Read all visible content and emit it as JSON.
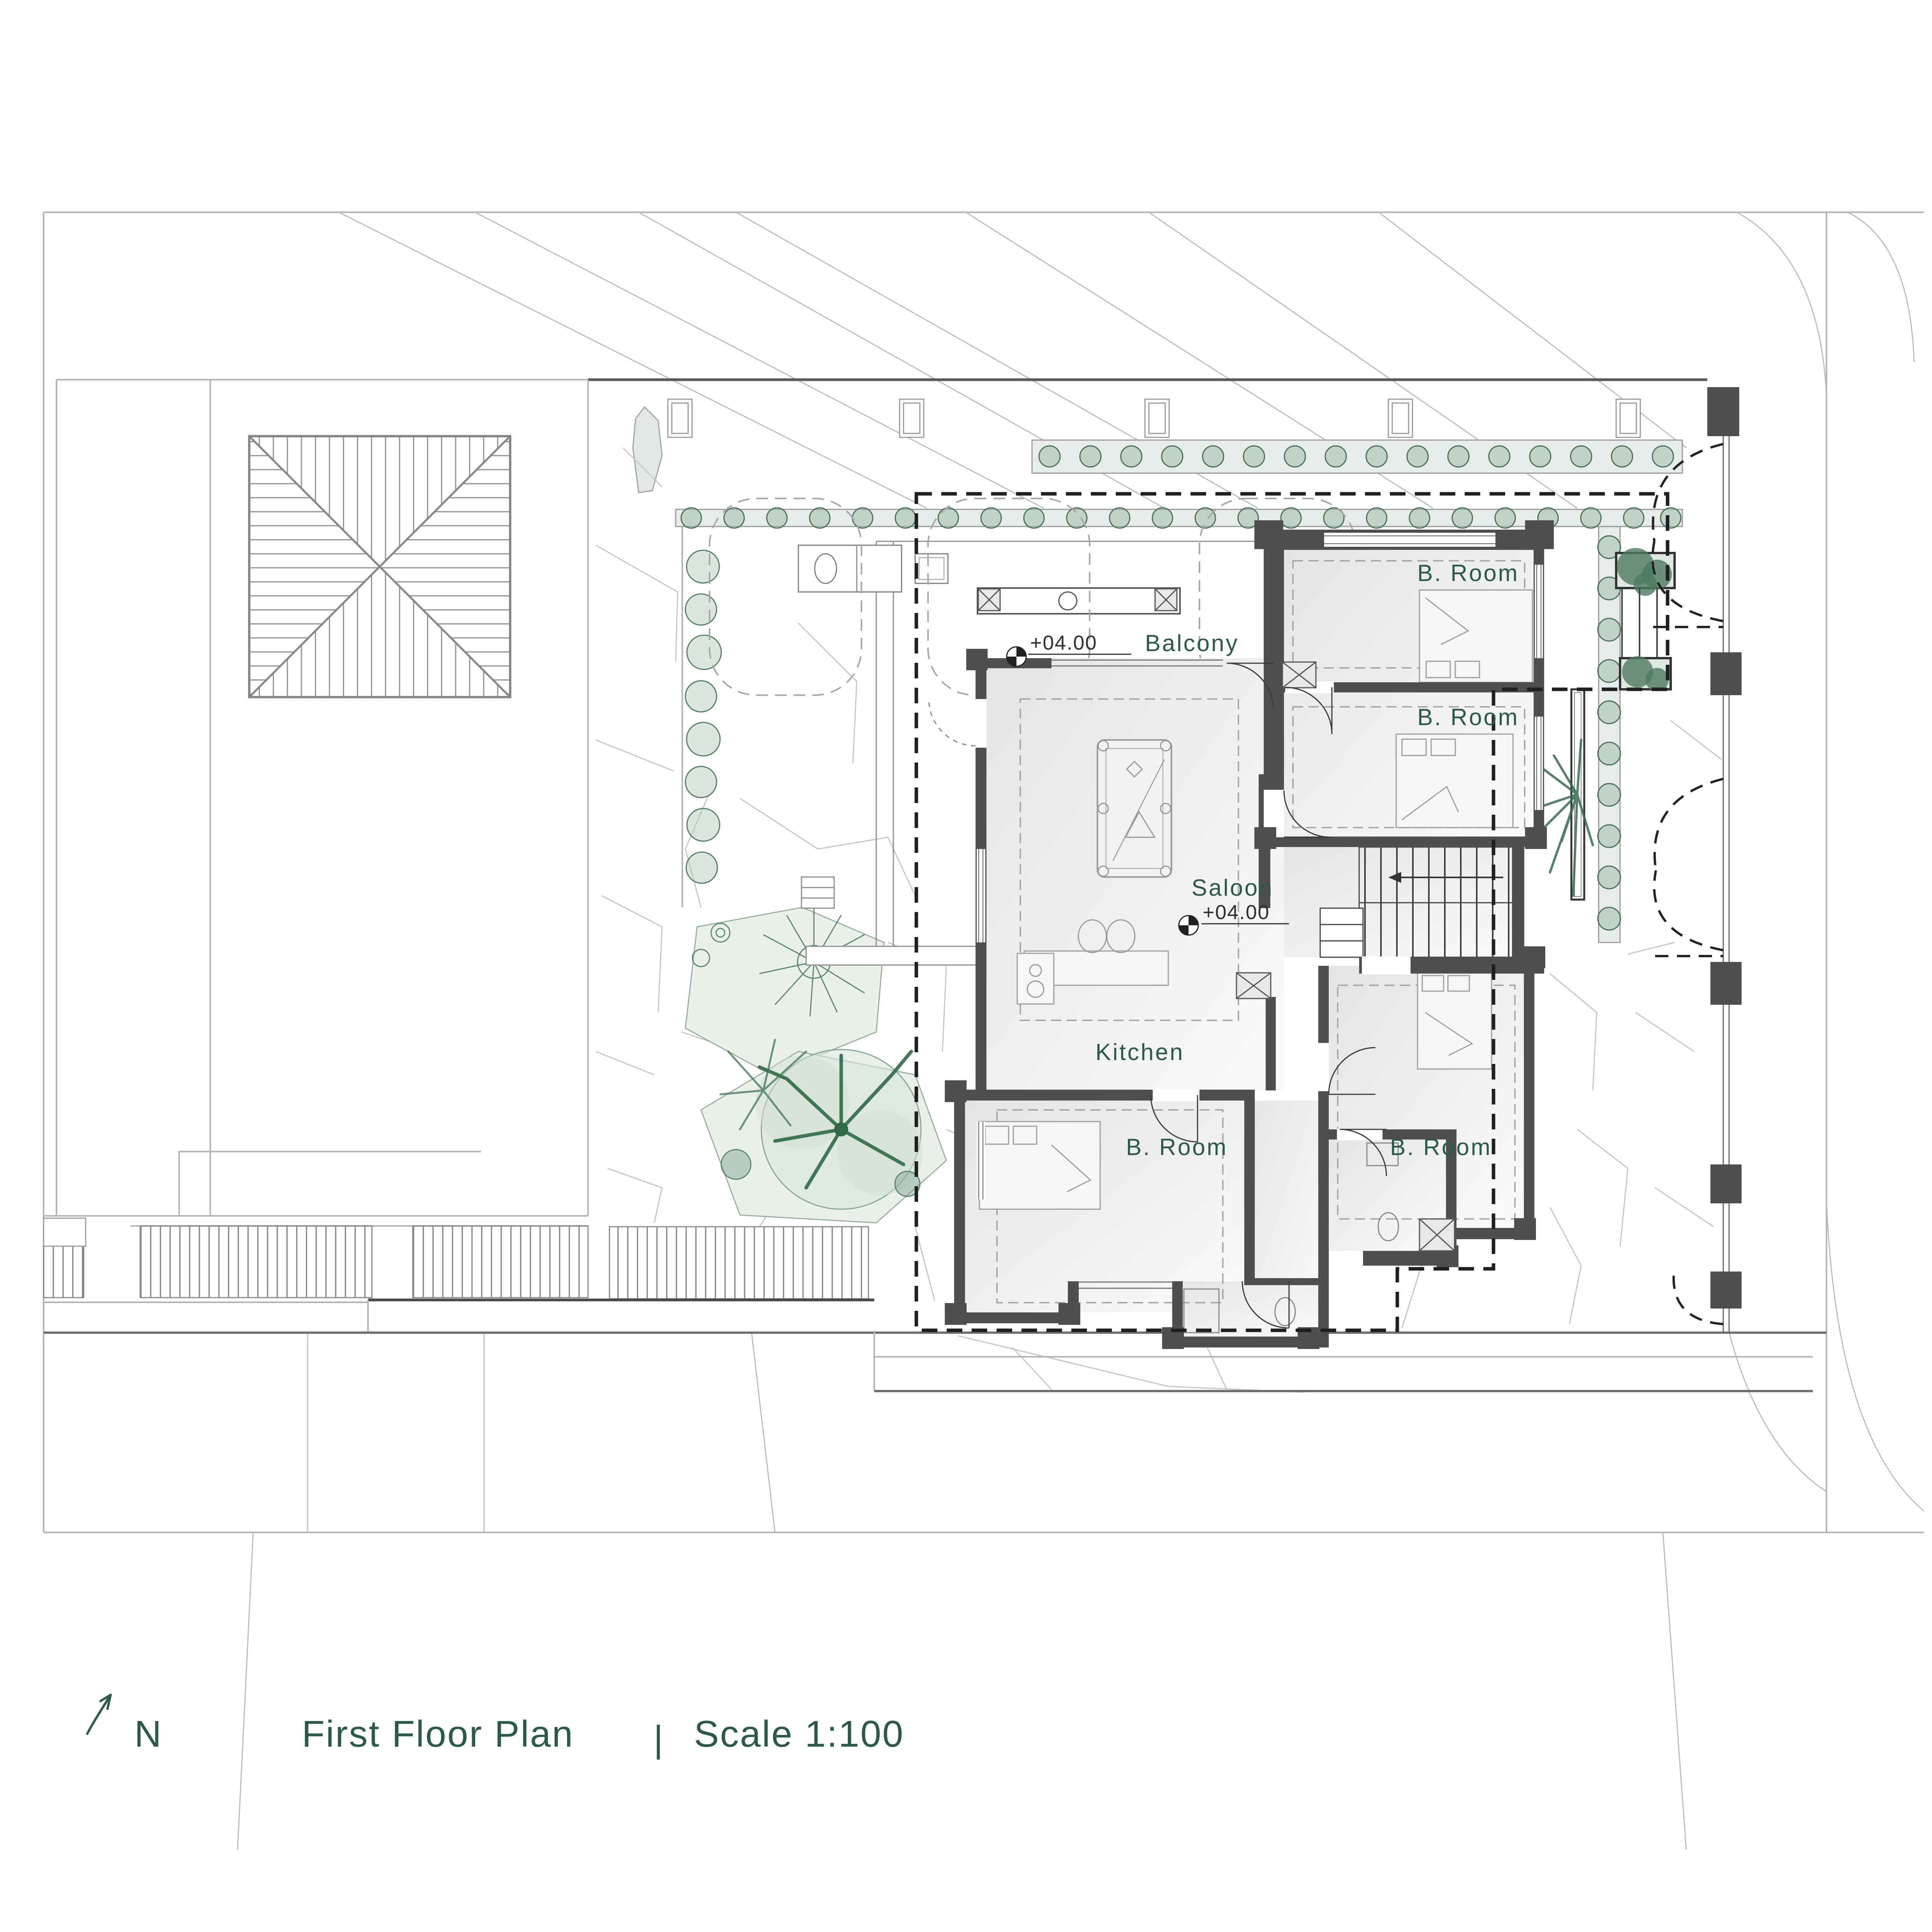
{
  "title_block": {
    "north_label": "N",
    "plan_title": "First Floor Plan",
    "separator": "|",
    "scale_label": "Scale 1:100"
  },
  "rooms": {
    "balcony": "Balcony",
    "saloon": "Saloon",
    "kitchen": "Kitchen",
    "bedroom_short": "B. Room"
  },
  "levels": {
    "balcony": "+04.00",
    "saloon": "+04.00"
  },
  "icons": [
    "north-arrow-icon",
    "spot-level-icon"
  ],
  "colors": {
    "accent_green": "#2b5a48",
    "wall_dark": "#4f4f4f",
    "vegetation_green": "#4e7a63",
    "planter_fill": "#e8ece8",
    "paving_line": "#c6c6c6"
  }
}
